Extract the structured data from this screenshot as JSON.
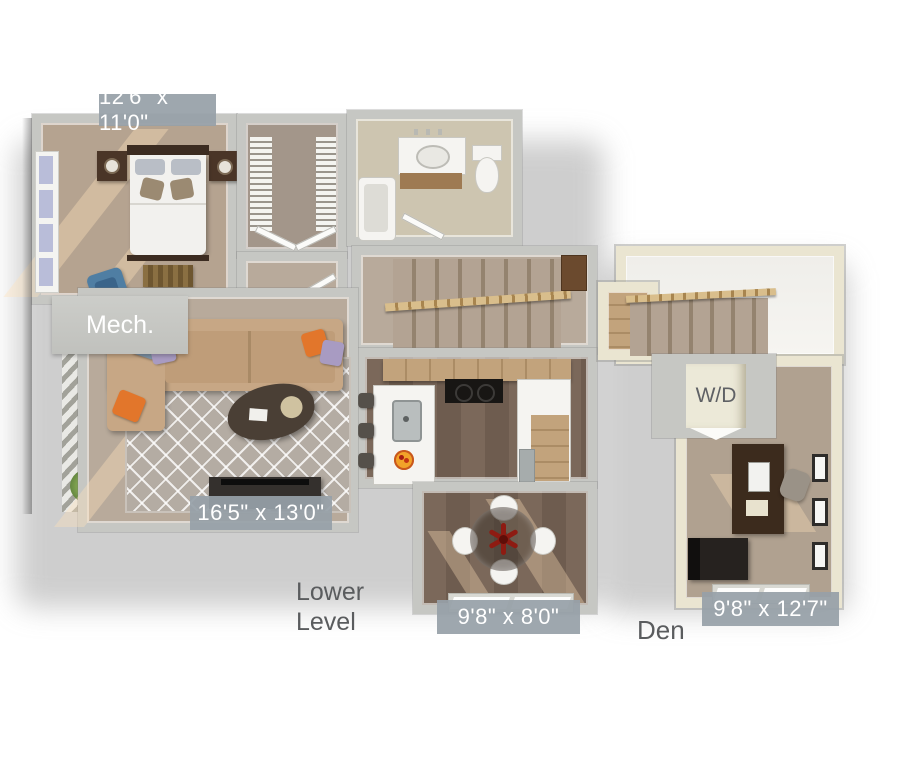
{
  "labels": {
    "bedroom_dim": "12'6\" x 11'0\"",
    "living_dim": "16'5\" x 13'0\"",
    "dining_dim": "9'8\" x 8'0\"",
    "den_dim": "9'8\" x 12'7\"",
    "mech": "Mech.",
    "washer_dryer": "W/D",
    "lower_level_line1": "Lower",
    "lower_level_line2": "Level",
    "den": "Den"
  },
  "colors": {
    "badge_bg": "#97a0a8",
    "badge_text": "#ffffff",
    "caption_text": "#5a5c5e",
    "wall_main": "#c6c7c3",
    "wall_cream": "#eae5d1",
    "carpet_bedroom": "#b5a390",
    "carpet_living": "#b8aa9b",
    "carpet_closet": "#a3968a",
    "carpet_den": "#b0a190",
    "wood_floor": "#7b685a",
    "wood_floor_dark": "#6e5c4f",
    "wood_cabinet": "#c2a37c",
    "tile_bath": "#cdc5b0",
    "rug_gray": "#b4aca3",
    "sofa_tan": "#c7a785",
    "accent_orange": "#e2762b",
    "accent_lavender": "#a89bc2",
    "accent_steel_blue": "#7d93a6",
    "chair_blue": "#4f7ea3",
    "flower_red": "#8e1b12",
    "dark_wood": "#42301f",
    "black_furniture": "#26221f",
    "white_fixture": "#f5f4f1",
    "railing_wood": "#d9be8c"
  }
}
